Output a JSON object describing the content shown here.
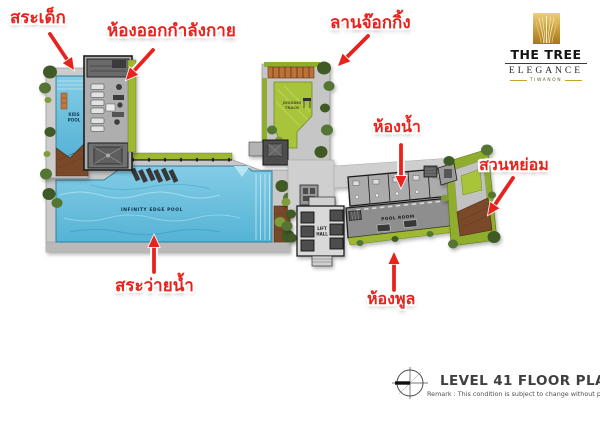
{
  "annotations": {
    "kids_pool": "สระเด็ก",
    "fitness_room": "ห้องออกกำลังกาย",
    "jogging_area": "ลานจ๊อกกิ้ง",
    "bathroom": "ห้องน้ำ",
    "garden": "สวนหย่อม",
    "swimming_pool": "สระว่ายน้ำ",
    "pool_room": "ห้องพูล"
  },
  "plan": {
    "kids_pool_line1": "KIDS",
    "kids_pool_line2": "POOL",
    "infinity_pool": "INFINITY EDGE POOL",
    "jogging_line1": "JOGGING",
    "jogging_line2": "TRACK",
    "lift_line1": "LIFT",
    "lift_line2": "HALL",
    "pool_room": "POOL ROOM"
  },
  "logo": {
    "name": "THE TREE",
    "sub": "ELEGANCE",
    "location": "TIWANON"
  },
  "title_block": {
    "title": "LEVEL 41 FLOOR PLAN",
    "remark": "Remark : This condition is subject to change without prior notice"
  },
  "colors": {
    "annotation_red": "#e8231d",
    "pool_blue": "#6ec3de",
    "lawn_green": "#a8c43b",
    "tree_green": "#3f5a26",
    "deck_gray": "#c8c8c8",
    "wood_brown": "#7a4a2b",
    "logo_gold": "#c9a227"
  }
}
